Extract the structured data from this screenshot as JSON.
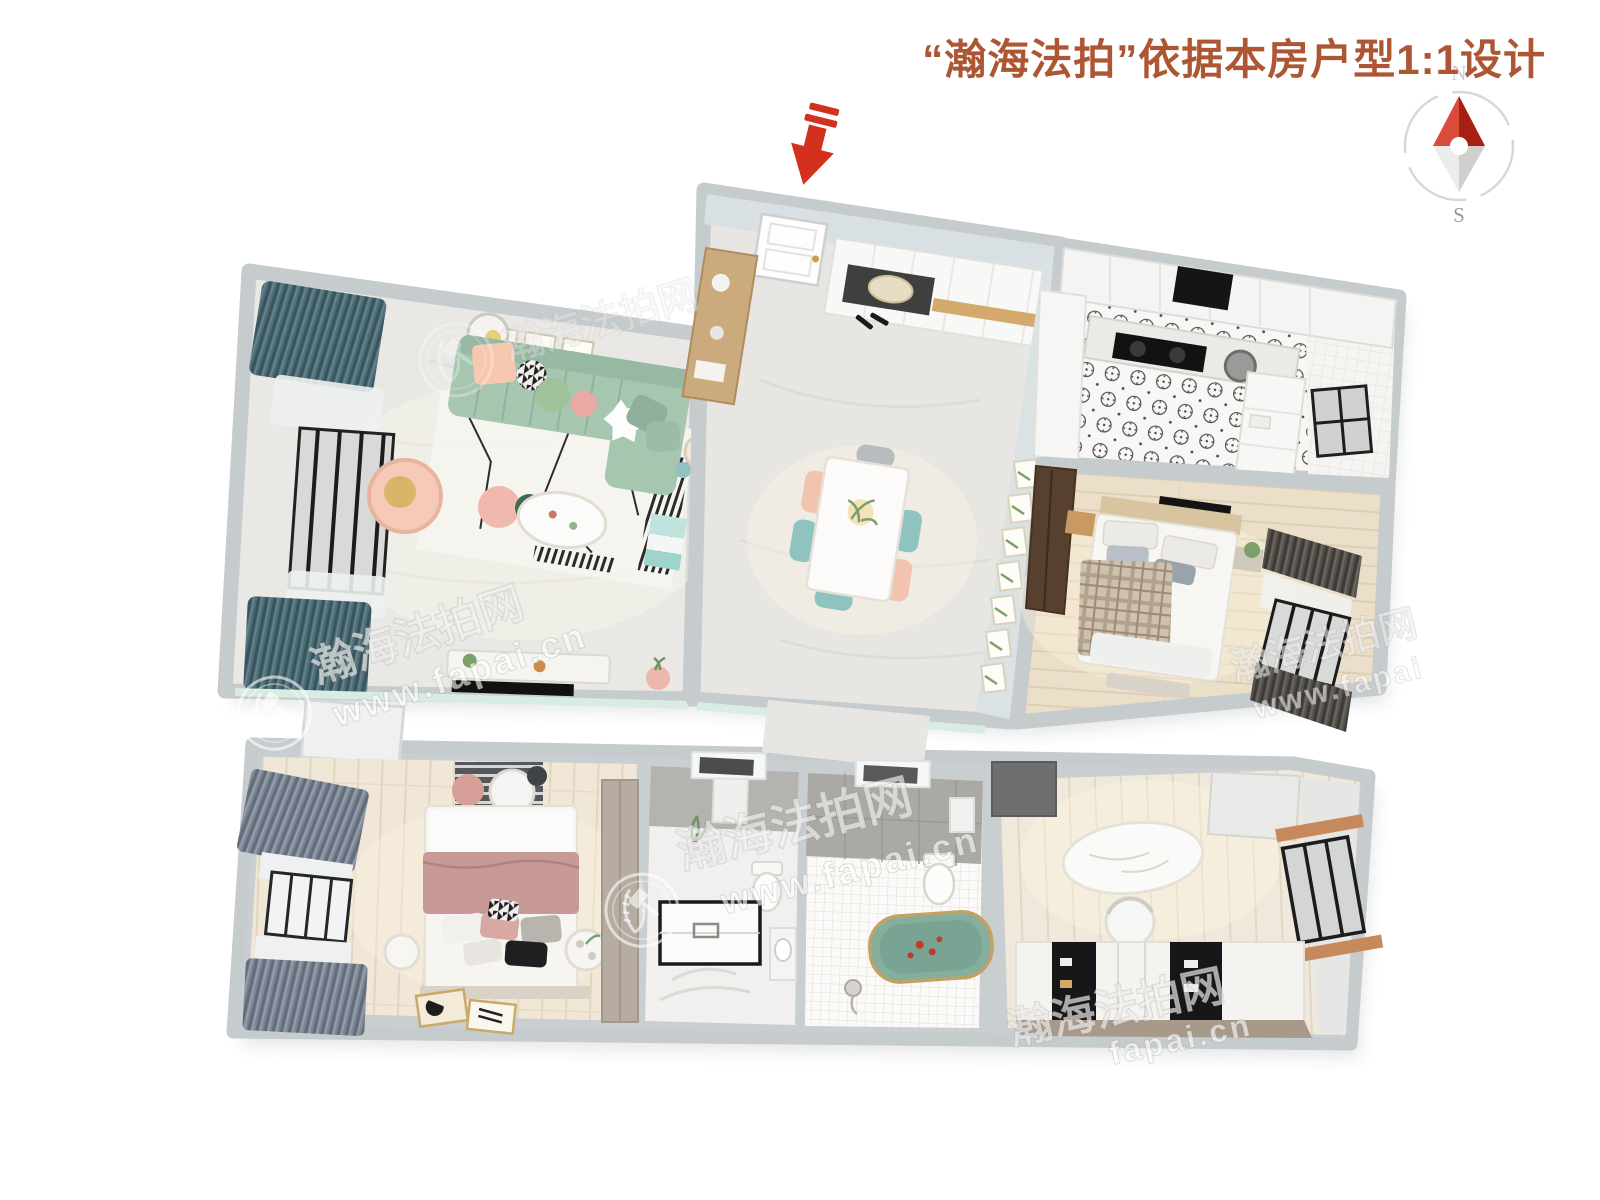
{
  "page": {
    "width": 1600,
    "height": 1200,
    "background": "#ffffff"
  },
  "header": {
    "title": "“瀚海法拍”依据本房户型1:1设计",
    "title_color": "#ad5633"
  },
  "compass": {
    "north_label": "N",
    "south_label": "S",
    "ring_color": "#d8d8d8",
    "needle_north_left": "#d94b3a",
    "needle_north_right": "#a81f13",
    "needle_south_left": "#ececea",
    "needle_south_right": "#cfcfcd",
    "label_n_color": "#cccccc",
    "label_s_color": "#999999"
  },
  "entrance": {
    "arrow_color": "#d3301d"
  },
  "watermark": {
    "brand": "瀚海法拍网",
    "url": "www.fapai.cn",
    "url_short": "fapai.cn",
    "url_partial": "www.fapai"
  },
  "palette": {
    "wall": "#c6cbce",
    "wall_inner": "#d9e0e3",
    "floor_marble": "#e9e8e5",
    "floor_wood": "#ecdfca",
    "floor_wood_light": "#f0e7d7",
    "sofa_green": "#a6c6b0",
    "curtain_teal": "#4e6e78",
    "curtain_gray": "#7e8795",
    "curtain_dark": "#56534e",
    "bed_pink": "#c79a98",
    "bathtub_green": "#86ae9d",
    "dining_pink": "#f2c3ae",
    "dining_teal": "#8fc3c0",
    "wood_console": "#cbaa7e",
    "wardrobe_dark": "#57402f",
    "mint_wall": "#d9ece4"
  }
}
